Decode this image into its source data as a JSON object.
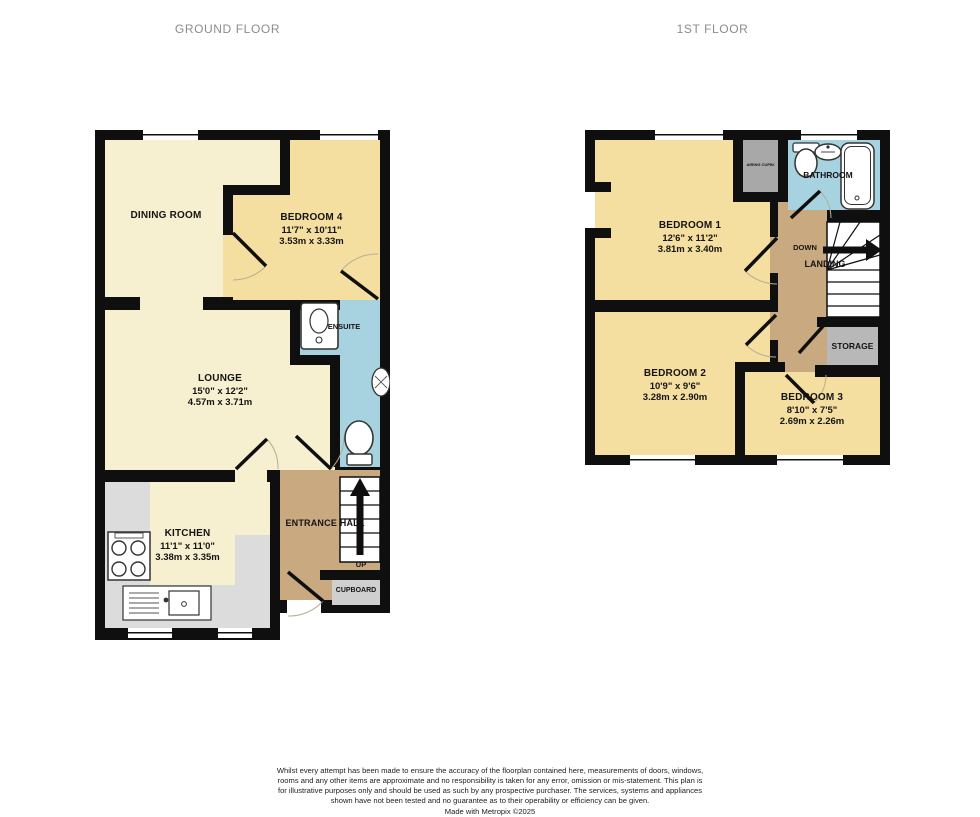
{
  "header": {
    "ground_title": "GROUND FLOOR",
    "first_title": "1ST FLOOR"
  },
  "ground_floor": {
    "dining_room": {
      "name": "DINING ROOM"
    },
    "bedroom4": {
      "name": "BEDROOM 4",
      "size_imperial": "11'7\" x 10'11\"",
      "size_metric": "3.53m x 3.33m"
    },
    "lounge": {
      "name": "LOUNGE",
      "size_imperial": "15'0\" x 12'2\"",
      "size_metric": "4.57m x 3.71m"
    },
    "ensuite": {
      "name": "ENSUITE"
    },
    "kitchen": {
      "name": "KITCHEN",
      "size_imperial": "11'1\" x 11'0\"",
      "size_metric": "3.38m x 3.35m"
    },
    "entrance_hall": {
      "name": "ENTRANCE HALL",
      "stairs_label": "UP"
    },
    "cupboard": {
      "name": "CUPBOARD"
    }
  },
  "first_floor": {
    "bedroom1": {
      "name": "BEDROOM 1",
      "size_imperial": "12'6\" x 11'2\"",
      "size_metric": "3.81m x 3.40m"
    },
    "bedroom2": {
      "name": "BEDROOM 2",
      "size_imperial": "10'9\" x 9'6\"",
      "size_metric": "3.28m x 2.90m"
    },
    "bedroom3": {
      "name": "BEDROOM 3",
      "size_imperial": "8'10\" x 7'5\"",
      "size_metric": "2.69m x 2.26m"
    },
    "bathroom": {
      "name": "BATHROOM"
    },
    "landing": {
      "name": "LANDING",
      "stairs_label": "DOWN"
    },
    "storage": {
      "name": "STORAGE"
    },
    "airing_cupboard": {
      "name": "AIRING CUPBOARD"
    }
  },
  "footer": {
    "disclaimer": "Whilst every attempt has been made to ensure the accuracy of the floorplan contained here, measurements of doors, windows, rooms and any other items are approximate and no responsibility is taken for any error, omission or mis-statement. This plan is for illustrative purposes only and should be used as such by any prospective purchaser. The services, systems and appliances shown have not been tested and no guarantee as to their operability or efficiency can be given.",
    "credit": "Made with Metropix ©2025"
  },
  "colors": {
    "wall": "#0f0f0f",
    "room_cream": "#f7f0d0",
    "room_yellow": "#f5dfa0",
    "wet_room_blue": "#a7d2e0",
    "hall_tan": "#c9a97f",
    "storage_gray": "#b8b8b8",
    "counter_gray": "#dcdcdc",
    "title_gray": "#8c8c8c"
  }
}
